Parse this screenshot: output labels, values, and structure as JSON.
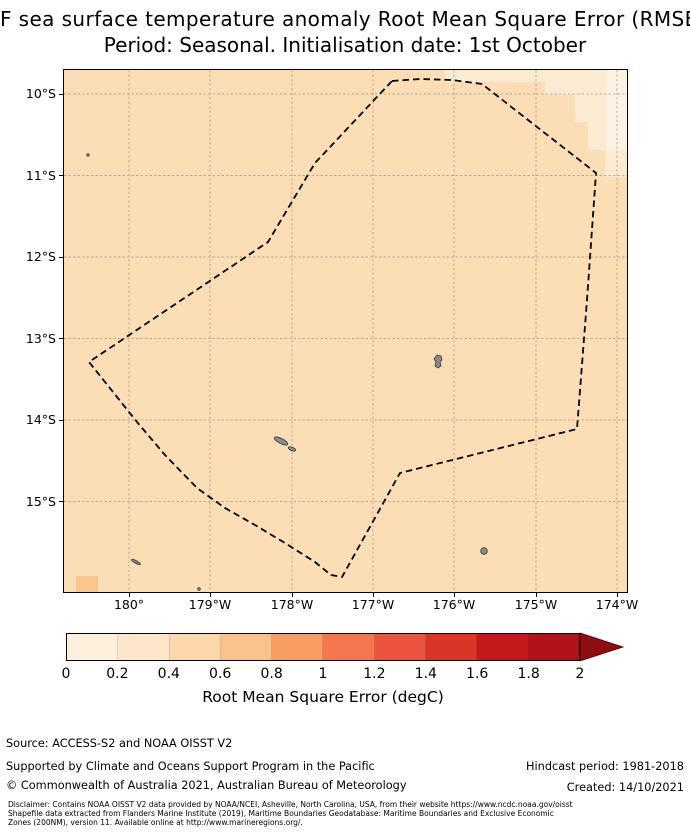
{
  "title": {
    "line1": "F sea surface temperature anomaly Root Mean Square Error (RMSE",
    "line2": "Period: Seasonal. Initialisation date: 1st October"
  },
  "map": {
    "y_ticks": [
      {
        "label": "10°S"
      },
      {
        "label": "11°S"
      },
      {
        "label": "12°S"
      },
      {
        "label": "13°S"
      },
      {
        "label": "14°S"
      },
      {
        "label": "15°S"
      }
    ],
    "x_ticks": [
      {
        "label": "180°"
      },
      {
        "label": "179°W"
      },
      {
        "label": "178°W"
      },
      {
        "label": "177°W"
      },
      {
        "label": "176°W"
      },
      {
        "label": "175°W"
      },
      {
        "label": "174°W"
      }
    ],
    "colors": {
      "sea": "#fbdeb5",
      "light_cells": "#fcebd3",
      "lightest_cells": "#fdf3e4",
      "darker_cell": "#f9c78c",
      "grid": "#979087",
      "boundary": "#000000",
      "island": "#8a8a8a"
    }
  },
  "colorbar": {
    "ticks": [
      {
        "label": "0"
      },
      {
        "label": "0.2"
      },
      {
        "label": "0.4"
      },
      {
        "label": "0.6"
      },
      {
        "label": "0.8"
      },
      {
        "label": "1"
      },
      {
        "label": "1.2"
      },
      {
        "label": "1.4"
      },
      {
        "label": "1.6"
      },
      {
        "label": "1.8"
      },
      {
        "label": "2"
      }
    ],
    "colors": [
      "#fdf1de",
      "#fce5c8",
      "#fbd7ab",
      "#fac28b",
      "#f89e64",
      "#f4764f",
      "#ed543f",
      "#da3628",
      "#c6191d",
      "#b11218"
    ],
    "arrow_color": "#8e0c12",
    "label": "Root Mean Square Error (degC)"
  },
  "footer": {
    "source": "Source: ACCESS-S2 and NOAA OISST V2",
    "supported": "Supported by Climate and Oceans Support Program in the Pacific",
    "copyright": "© Commonwealth of Australia 2021, Australian Bureau of Meteorology",
    "hindcast": "Hindcast period: 1981-2018",
    "created": "Created: 14/10/2021"
  },
  "disclaimer": {
    "line1": "Disclaimer: Contains NOAA OISST V2 data provided by NOAA/NCEI, Asheville, North Carolina, USA, from their website https://www.ncdc.noaa.gov/oisst",
    "line2": "Shapefile data extracted from Flanders Marine Institute (2019), Maritime Boundaries Geodatabase: Maritime Boundaries and Exclusive Economic",
    "line3": "Zones (200NM), version 11. Available online at http://www.marineregions.org/."
  },
  "chart_data": {
    "type": "heatmap",
    "title": "F sea surface temperature anomaly Root Mean Square Error (RMSE",
    "subtitle": "Period: Seasonal. Initialisation date: 1st October",
    "x_tick_labels": [
      "180°",
      "179°W",
      "178°W",
      "177°W",
      "176°W",
      "175°W",
      "174°W"
    ],
    "y_tick_labels": [
      "10°S",
      "11°S",
      "12°S",
      "13°S",
      "14°S",
      "15°S"
    ],
    "xlim_lon": [
      -180.8,
      -173.86
    ],
    "ylim_lat": [
      -16.14,
      -9.71
    ],
    "grid": true,
    "colorbar": {
      "label": "Root Mean Square Error (degC)",
      "ticks": [
        0,
        0.2,
        0.4,
        0.6,
        0.8,
        1,
        1.2,
        1.4,
        1.6,
        1.8,
        2
      ],
      "extend": "max",
      "bin_colors": [
        "#fdf1de",
        "#fce5c8",
        "#fbd7ab",
        "#fac28b",
        "#f89e64",
        "#f4764f",
        "#ed543f",
        "#da3628",
        "#c6191d",
        "#b11218"
      ],
      "over_color": "#8e0c12"
    },
    "field_summary": {
      "dominant_bin_degC": "0.4-0.6",
      "northeast_corner_bins_degC": "0.0-0.4 (lighter staircase of cells)",
      "southwest_bottom_edge_cell_degC": "0.6-0.8"
    },
    "boundary_polygon_lonlat": [
      [
        -176.77,
        -9.85
      ],
      [
        -175.66,
        -9.89
      ],
      [
        -174.25,
        -10.98
      ],
      [
        -174.36,
        -12.55
      ],
      [
        -174.49,
        -14.08
      ],
      [
        -176.67,
        -14.67
      ],
      [
        -177.38,
        -15.95
      ],
      [
        -179.9,
        -14.05
      ],
      [
        -180.49,
        -13.31
      ],
      [
        -178.29,
        -11.83
      ],
      [
        -177.71,
        -10.86
      ]
    ],
    "islands_lonlat": {
      "wallis": [
        -176.21,
        -13.23
      ],
      "futuna": [
        -178.13,
        -14.28
      ],
      "alofi": [
        -178.0,
        -14.38
      ],
      "niuafoou": [
        -175.63,
        -15.63
      ]
    }
  }
}
